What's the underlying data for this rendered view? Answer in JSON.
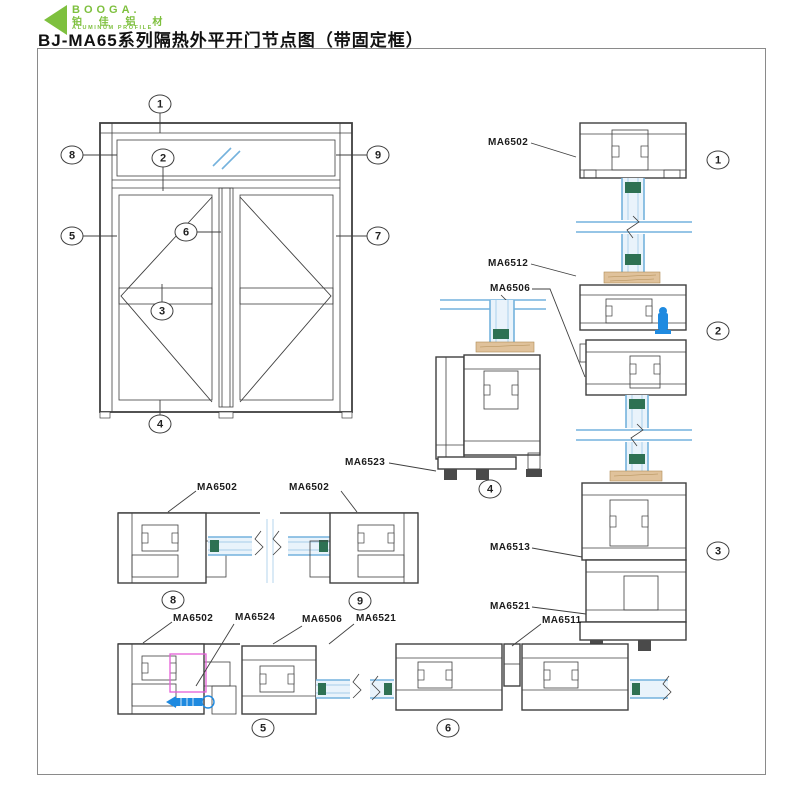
{
  "header": {
    "logo": {
      "brand": "BOOGA.",
      "brand_cn": "铂 佳 铝 材",
      "brand_sub": "ALUMINUM PROFILE"
    },
    "title": "BJ-MA65系列隔热外平开门节点图（带固定框）"
  },
  "elevation": {
    "callouts": {
      "c1": "1",
      "c2": "2",
      "c3": "3",
      "c4": "4",
      "c5": "5",
      "c6": "6",
      "c7": "7",
      "c8": "8",
      "c9": "9"
    }
  },
  "sections": {
    "marks": {
      "s1": "1",
      "s2": "2",
      "s3": "3",
      "s4": "4",
      "s5": "5",
      "s6": "6",
      "s8": "8",
      "s9": "9"
    }
  },
  "part_labels": {
    "sec1_frame": "MA6502",
    "sec2_glazing_bead": "MA6512",
    "sec2_adapter": "MA6506",
    "sec4_threshold": "MA6523",
    "sec3_mid_rail": "MA6513",
    "sec3_leaf_bottom": "MA6521",
    "sec6_astragal": "MA6511",
    "sec8_frame": "MA6502",
    "sec9_frame": "MA6502",
    "sec5_frame": "MA6502",
    "sec5_corner_joint": "MA6524",
    "sec5_adapter": "MA6506",
    "sec5_leaf": "MA6521"
  },
  "colors": {
    "line": "#3f3f3f",
    "glass_blue": "#74b2dd",
    "glass_fill": "#e9f3fb",
    "gasket_green": "#2e7153",
    "wood_tan": "#e0c29b",
    "highlight_magenta": "#e55fd7",
    "handle_blue": "#1f8ae0",
    "accent_green": "#7ec03e",
    "frame_border": "#8a8a8a"
  }
}
